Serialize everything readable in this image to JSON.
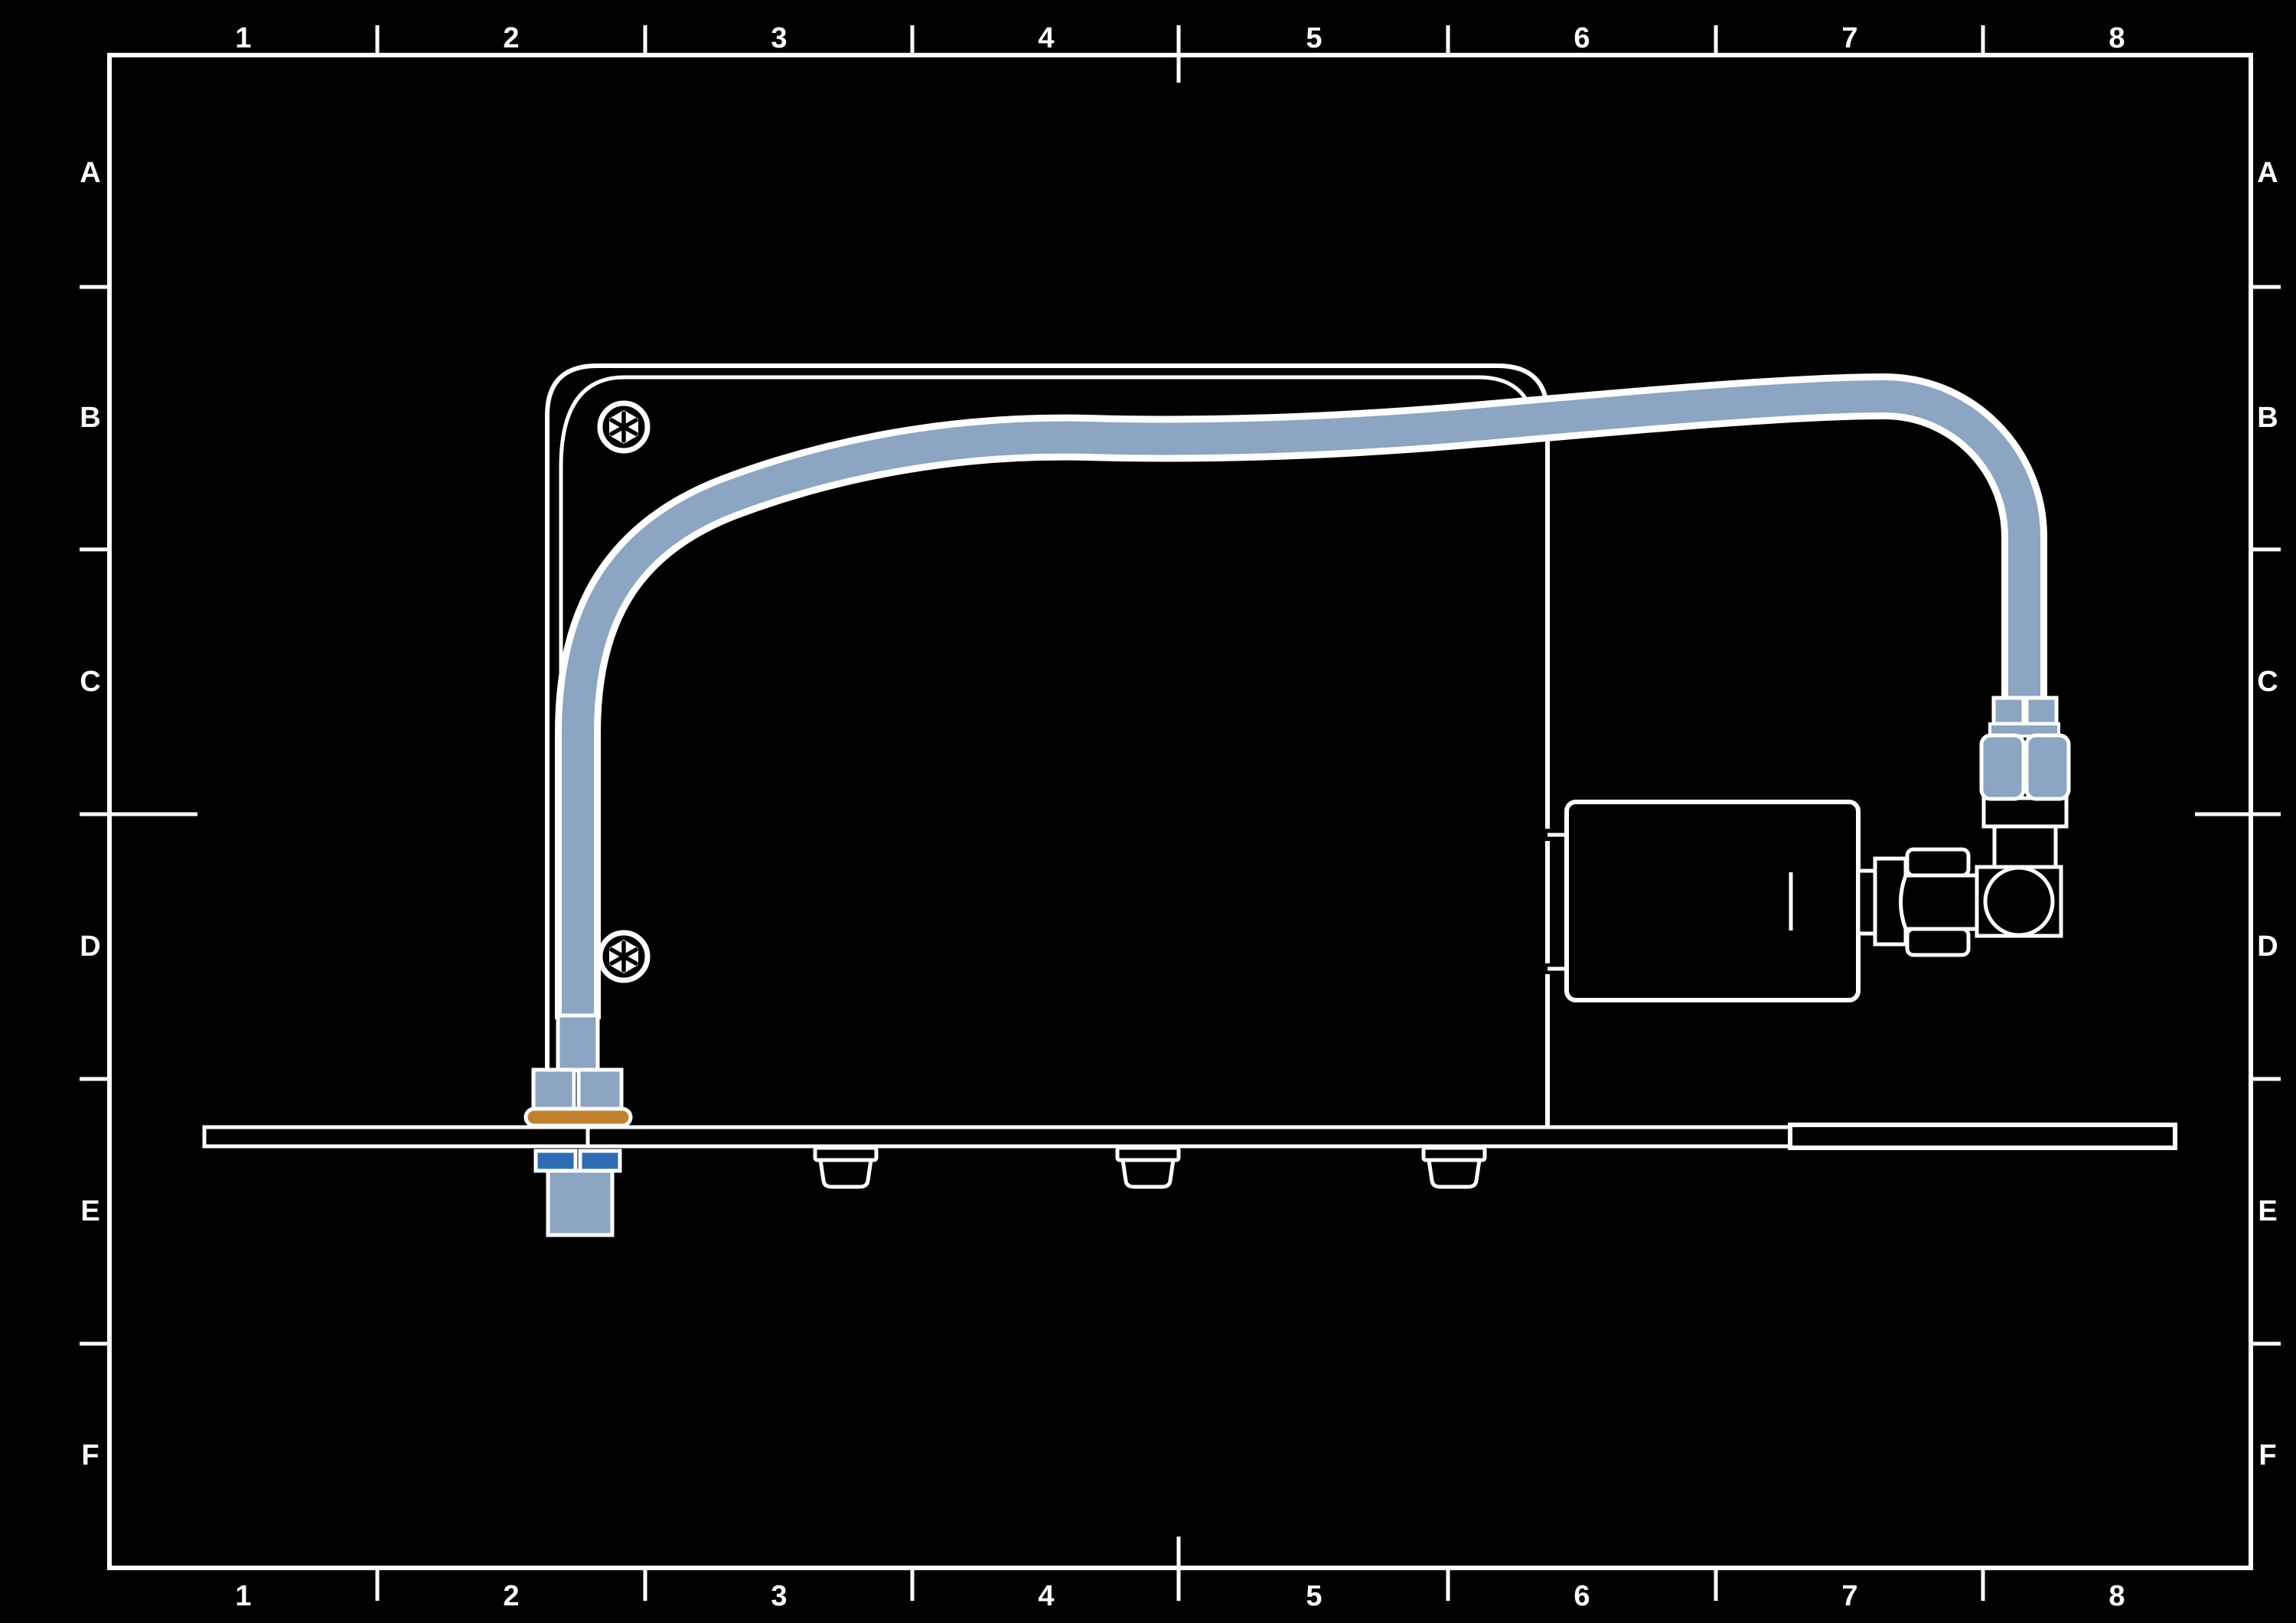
{
  "frame": {
    "columns": [
      "1",
      "2",
      "3",
      "4",
      "5",
      "6",
      "7",
      "8"
    ],
    "rows": [
      "A",
      "B",
      "C",
      "D",
      "E",
      "F"
    ]
  },
  "colors": {
    "background": "#000000",
    "line": "#ffffff",
    "tube": "#8ba5c3",
    "accent_blue": "#2e6cb4",
    "gasket_orange": "#c1802d"
  },
  "icons": {
    "screw_head": "hex-socket-screw-icon"
  }
}
